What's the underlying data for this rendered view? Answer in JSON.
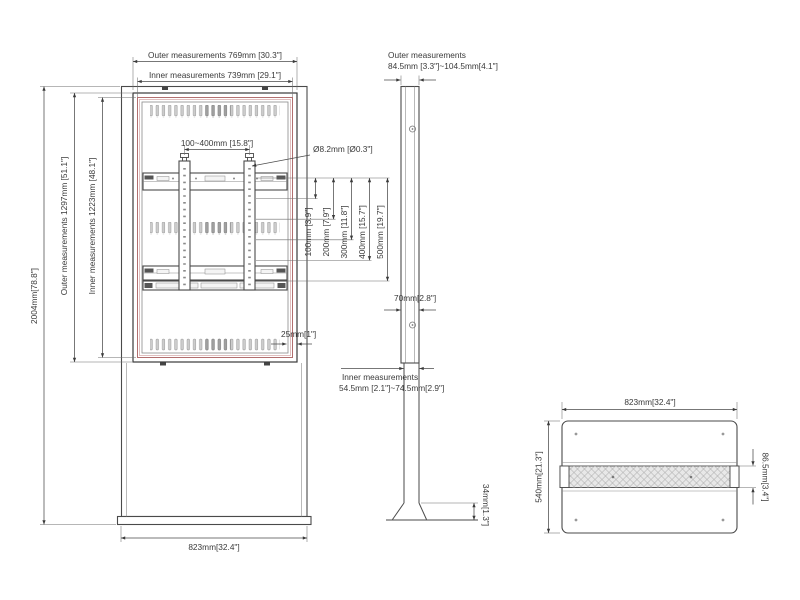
{
  "colors": {
    "line": "#4a4a4a",
    "accent_red": "#b26f6f",
    "accent_pink": "#d8b0b0",
    "slot_gray": "#c9c9c9"
  },
  "front_view": {
    "dim_total_height": "2004mm[78.8\"]",
    "dim_outer_height": "Outer measurements  1297mm [51.1\"]",
    "dim_inner_height": "Inner measurements  1223mm [48.1\"]",
    "dim_outer_width": "Outer measurements 769mm [30.3\"]",
    "dim_inner_width": "Inner measurements 739mm [29.1\"]",
    "dim_vesa_width": "100~400mm [15.8\"]",
    "dim_hole_diameter": "Ø8.2mm [Ø0.3\"]",
    "vesa_heights": [
      "100mm [3.9\"]",
      "200mm [7.9\"]",
      "300mm [11.8\"]",
      "400mm [15.7\"]",
      "500mm [19.7\"]"
    ],
    "dim_frame_width": "25mm[1\"]",
    "dim_base_width": "823mm[32.4\"]"
  },
  "side_view": {
    "outer_measurements_line1": "Outer measurements",
    "outer_measurements_line2": "84.5mm [3.3\"]~104.5mm[4.1\"]",
    "dim_depth": "70mm[2.8\"]",
    "inner_measurements_line1": "Inner measurements",
    "inner_measurements_line2": "54.5mm [2.1\"]~74.5mm[2.9\"]",
    "dim_foot_height": "34mm[1.3\"]"
  },
  "top_view": {
    "dim_width": "823mm[32.4\"]",
    "dim_depth": "540mm[21.3\"]",
    "dim_column_depth": "86.5mm[3.4\"]"
  }
}
